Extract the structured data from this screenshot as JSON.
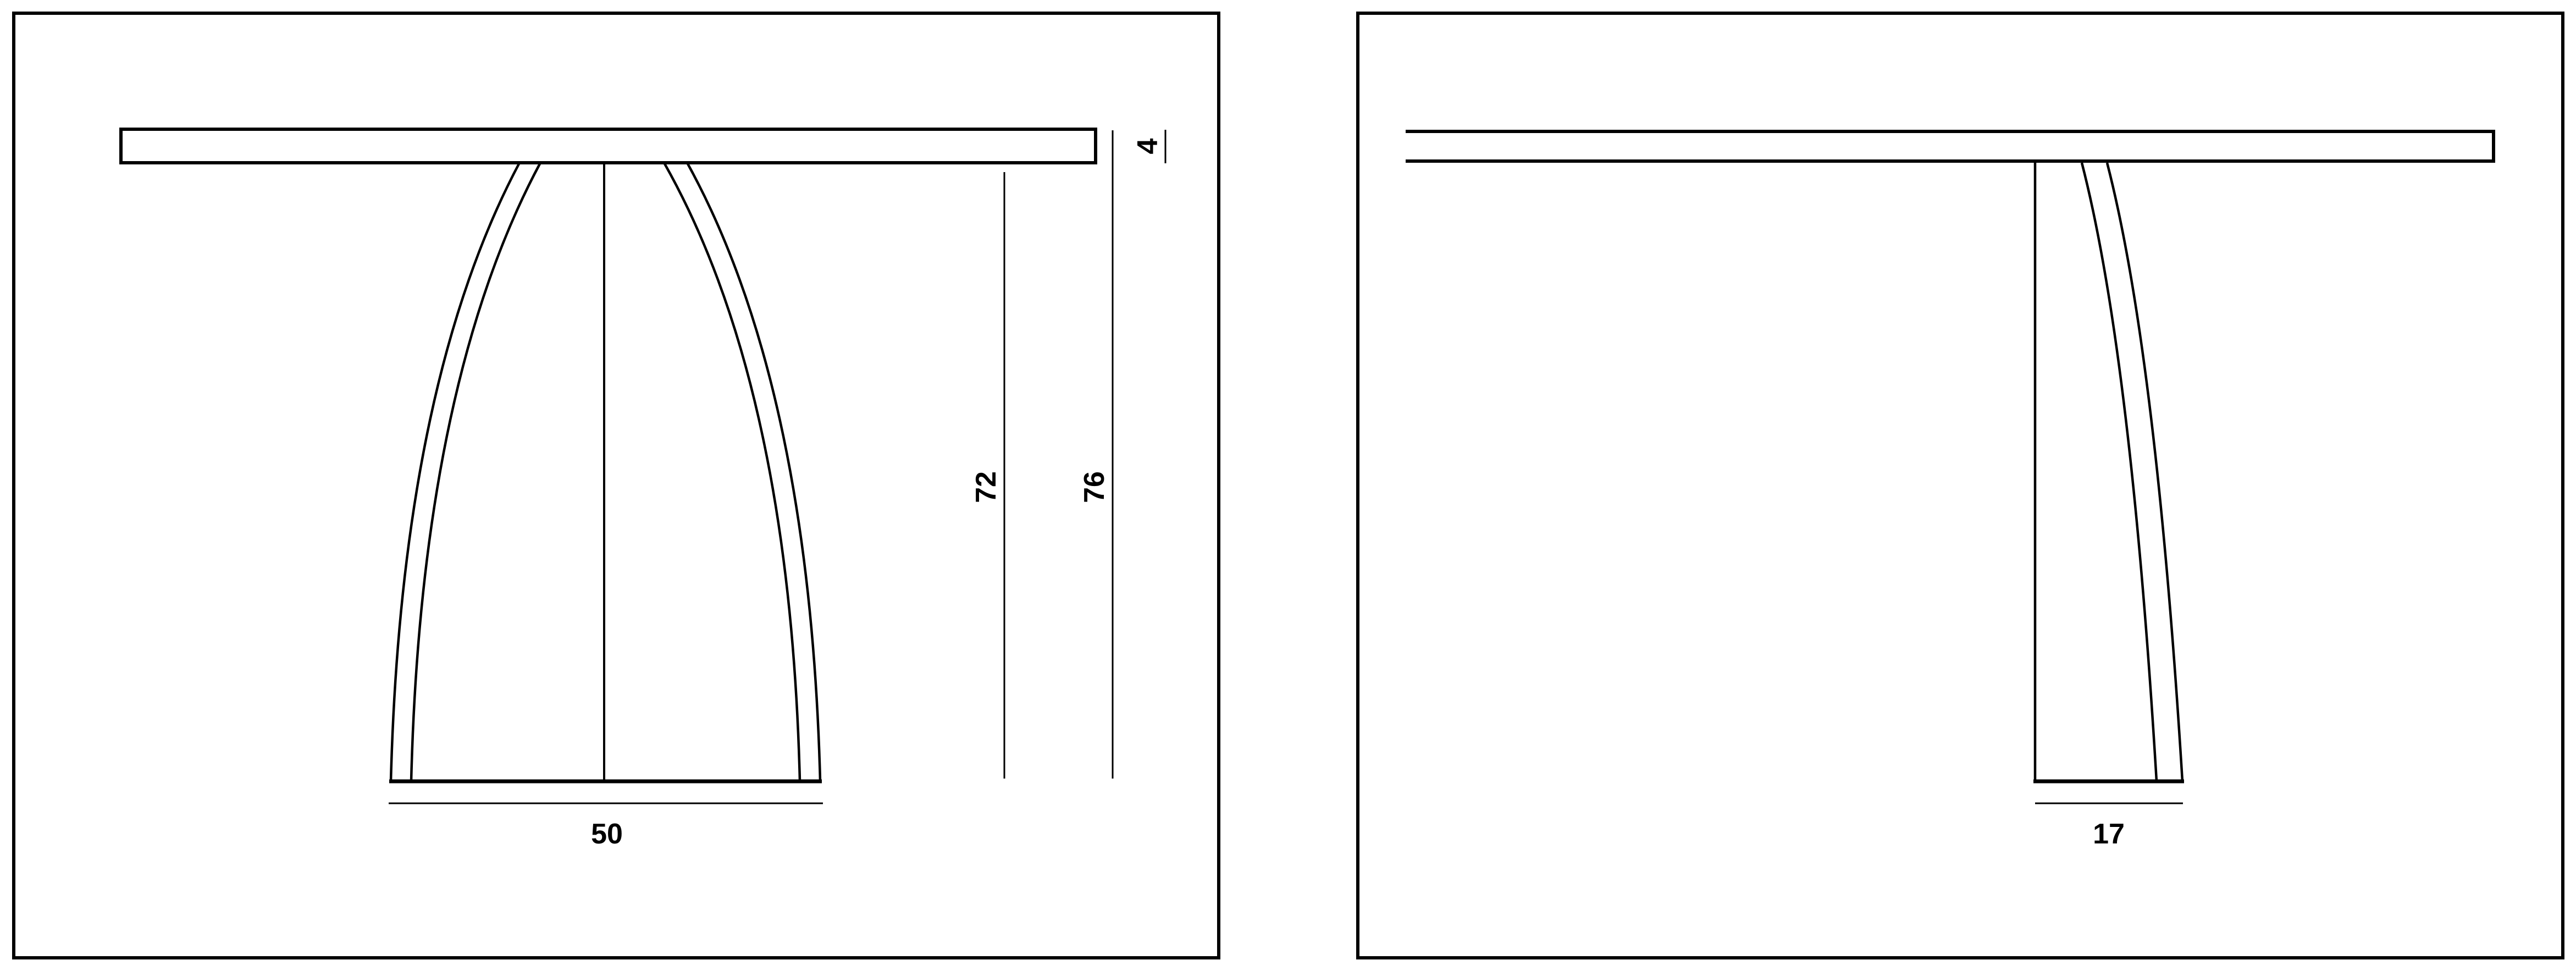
{
  "page": {
    "background": "#ffffff",
    "line_color": "#000000",
    "content_kind": "furniture technical drawing, front and side elevation of a pedestal table"
  },
  "views": {
    "front": {
      "id": "front-elevation"
    },
    "side": {
      "id": "side-elevation"
    }
  },
  "dims": {
    "top_thickness": "4",
    "underside_height": "72",
    "total_height": "76",
    "base_width": "50",
    "leg_depth": "17"
  }
}
